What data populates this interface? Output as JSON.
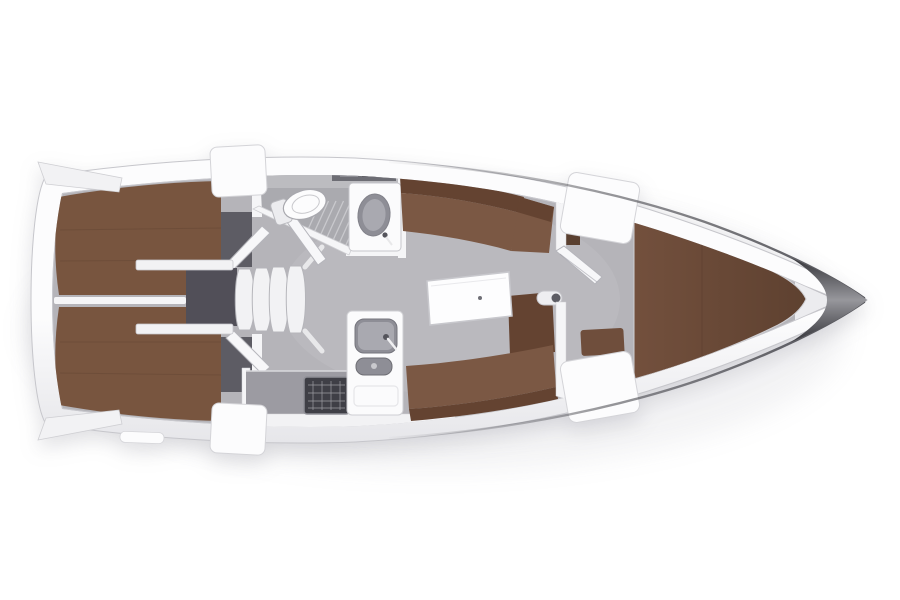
{
  "figure": {
    "kind": "yacht-interior-deck-plan",
    "orientation": {
      "bow": "right",
      "stern": "left"
    }
  },
  "regions": {
    "bow": "bow tip",
    "forward_cabin": "forward V-berth cabin",
    "salon": "salon with folding table and settees",
    "head": "head compartment with toilet, shower grate and washbasin",
    "galley": "galley with stove and twin sinks",
    "companionway": "companionway steps over engine box",
    "aft_cabin_port": "aft double berth cabin (port)",
    "aft_cabin_starboard": "aft double berth cabin (starboard)",
    "stern": "transom with swim step"
  },
  "colors": {
    "canvas": "#ffffff",
    "hull_top": "#fcfcfd",
    "hull_bottom": "#e4e4e8",
    "hull_edge": "#c6c6cb",
    "deck_shelf": "#e2e2e6",
    "toe_rail": "#47474d",
    "bow_dark": "#2e2e33",
    "bow_mid": "#97979c",
    "bow_wedge": "#ececef",
    "floor": "#b5b4b9",
    "floor_glow": "#ffffff",
    "berth_aft": "#78553f",
    "berth_seam": "#5d4130",
    "berth_fwd": "#73503d",
    "berth_fwd_dark": "#5e4130",
    "divider_white": "#f5f5f7",
    "cabin_floor": "#5d5c64",
    "engine_box": "#514f58",
    "step_face": "#f2f2f4",
    "door": "#f7f7f9",
    "bath_floor": "#aaaaaf",
    "bath_floor_light": "#c6c6ca",
    "grate": "#c9c9cd",
    "shelf": "#6d6d74",
    "shelf_item_light": "#8b8b92",
    "shelf_item_dark": "#5a5a61",
    "fixture": "#fbfbfc",
    "sink_basin": "#8e8e96",
    "sink_inner": "#a9a9b0",
    "metal_dark": "#55555c",
    "counter": "#9c9ba2",
    "counter_front": "#f2f2f4",
    "stove": "#3f3f46",
    "stove_grid": "#9c9ca3",
    "settee": "#7b5844",
    "settee_back": "#644331",
    "seat_fwd": "#6f4e3c",
    "wardrobe": "#5a4030",
    "table_top": "#fdfdfe",
    "table_edge": "#c8c8cd",
    "table_dot": "#6f6f76",
    "post": "#eeeef1",
    "post_dot": "#5d5d64",
    "hatch": "#fcfcfd",
    "hatch_edge": "#d4d4d8",
    "toilet_body": "#fcfcfd",
    "shadow_tint": "#8c8c99"
  }
}
